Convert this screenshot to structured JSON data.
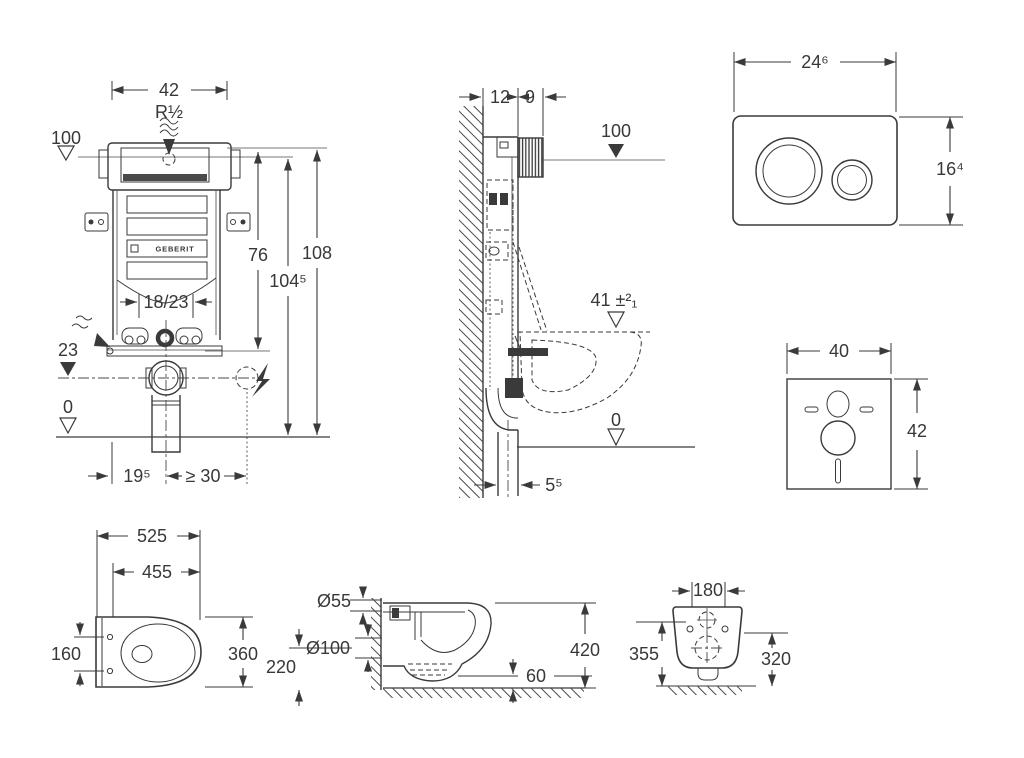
{
  "drawing": {
    "background": "#ffffff",
    "ink_color": "#3a3a3a"
  },
  "frame_front_view": {
    "width": "42",
    "inlet_thread": "R½",
    "inlet_level": "100",
    "height_76": "76",
    "height_108": "108",
    "height_104_5": "104⁵",
    "outlet_offset": "18/23",
    "outlet_level": "23",
    "floor_level": "0",
    "offset_19_5": "19⁵",
    "clearance_min_30": "≥ 30",
    "brand": "GEBERIT"
  },
  "frame_side_view": {
    "depth_12": "12",
    "depth_9": "9",
    "inlet_level": "100",
    "rim_height": "41 ±²₁",
    "floor_level": "0",
    "outlet_distance": "5⁵"
  },
  "flush_plate": {
    "width": "24⁶",
    "height": "16⁴"
  },
  "sound_mat": {
    "width": "40",
    "height": "42"
  },
  "pan_top_view": {
    "length": "525",
    "inner_length": "455",
    "hole_spacing": "160",
    "width": "360"
  },
  "pan_side_view": {
    "flush_diameter": "Ø55",
    "outlet_diameter": "Ø100",
    "outlet_height": "220",
    "depth": "420",
    "clearance": "60"
  },
  "pan_rear_view": {
    "hole_spacing": "180",
    "height_left": "355",
    "height_right": "320"
  }
}
